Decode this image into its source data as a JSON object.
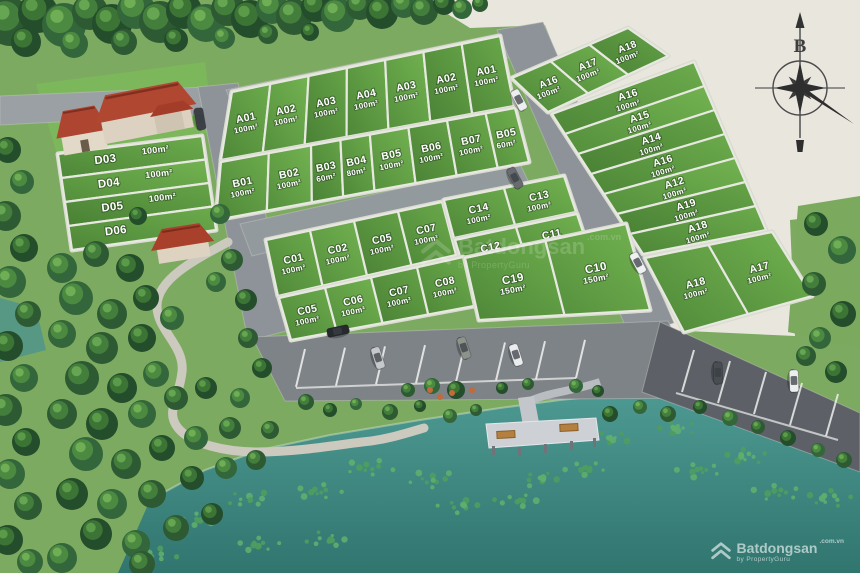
{
  "compass": {
    "north_label": "B"
  },
  "watermark": {
    "brand": "Batdongsan",
    "tld": ".com.vn",
    "byline": "by PropertyGuru"
  },
  "colors": {
    "plot_green": "#58923f",
    "lake_teal": "#3f8a84",
    "road_gray": "#8d9398",
    "land_beige": "#e9e6de",
    "roof_red": "#b04731"
  },
  "blocks": {
    "rowA": {
      "plots": [
        {
          "id": "A01",
          "area": "100m²"
        },
        {
          "id": "A02",
          "area": "100m²"
        },
        {
          "id": "A03",
          "area": "100m²"
        },
        {
          "id": "A04",
          "area": "100m²"
        },
        {
          "id": "A03",
          "area": "100m²"
        },
        {
          "id": "A02",
          "area": "100m²"
        },
        {
          "id": "A01",
          "area": "100m²"
        }
      ]
    },
    "rowB": {
      "plots": [
        {
          "id": "B01",
          "area": "100m²"
        },
        {
          "id": "B02",
          "area": "100m²"
        },
        {
          "id": "B03",
          "area": "60m²"
        },
        {
          "id": "B04",
          "area": "80m²"
        },
        {
          "id": "B05",
          "area": "100m²"
        },
        {
          "id": "B06",
          "area": "100m²"
        },
        {
          "id": "B07",
          "area": "100m²"
        },
        {
          "id": "B05",
          "area": "60m²"
        }
      ]
    },
    "topRight": {
      "plots": [
        {
          "id": "A16",
          "area": "100m²"
        },
        {
          "id": "A17",
          "area": "100m²"
        },
        {
          "id": "A18",
          "area": "100m²"
        }
      ]
    },
    "rightCol": {
      "plots": [
        {
          "id": "A16",
          "area": "100m²"
        },
        {
          "id": "A15",
          "area": "100m²"
        },
        {
          "id": "A14",
          "area": "100m²"
        },
        {
          "id": "A16",
          "area": "100m²"
        },
        {
          "id": "A12",
          "area": "100m²"
        },
        {
          "id": "A19",
          "area": "100m²"
        },
        {
          "id": "A18",
          "area": "100m²"
        }
      ]
    },
    "bottomRight": {
      "plots": [
        {
          "id": "A18",
          "area": "100m²"
        },
        {
          "id": "A17",
          "area": "100m²"
        }
      ]
    },
    "cTop": {
      "plots": [
        {
          "id": "C01",
          "area": "100m²"
        },
        {
          "id": "C02",
          "area": "100m²"
        },
        {
          "id": "C05",
          "area": "100m²"
        },
        {
          "id": "C07",
          "area": "100m²"
        }
      ]
    },
    "cR1": {
      "plots": [
        {
          "id": "C14",
          "area": "100m²"
        },
        {
          "id": "C13",
          "area": "100m²"
        }
      ]
    },
    "cR2": {
      "plots": [
        {
          "id": "C12",
          "area": "100m²"
        },
        {
          "id": "C11",
          "area": "100m²"
        }
      ]
    },
    "cBottom": {
      "plots": [
        {
          "id": "C05",
          "area": "100m²"
        },
        {
          "id": "C06",
          "area": "100m²"
        },
        {
          "id": "C07",
          "area": "100m²"
        },
        {
          "id": "C08",
          "area": "100m²"
        }
      ]
    },
    "cBig": {
      "plots": [
        {
          "id": "C19",
          "area": "150m²"
        },
        {
          "id": "C10",
          "area": "150m²"
        }
      ]
    },
    "dCol": {
      "plots": [
        {
          "id": "D03",
          "area": "100m²"
        },
        {
          "id": "D04",
          "area": "100m²"
        },
        {
          "id": "D05",
          "area": "100m²"
        },
        {
          "id": "D06",
          "area": ""
        }
      ]
    }
  }
}
